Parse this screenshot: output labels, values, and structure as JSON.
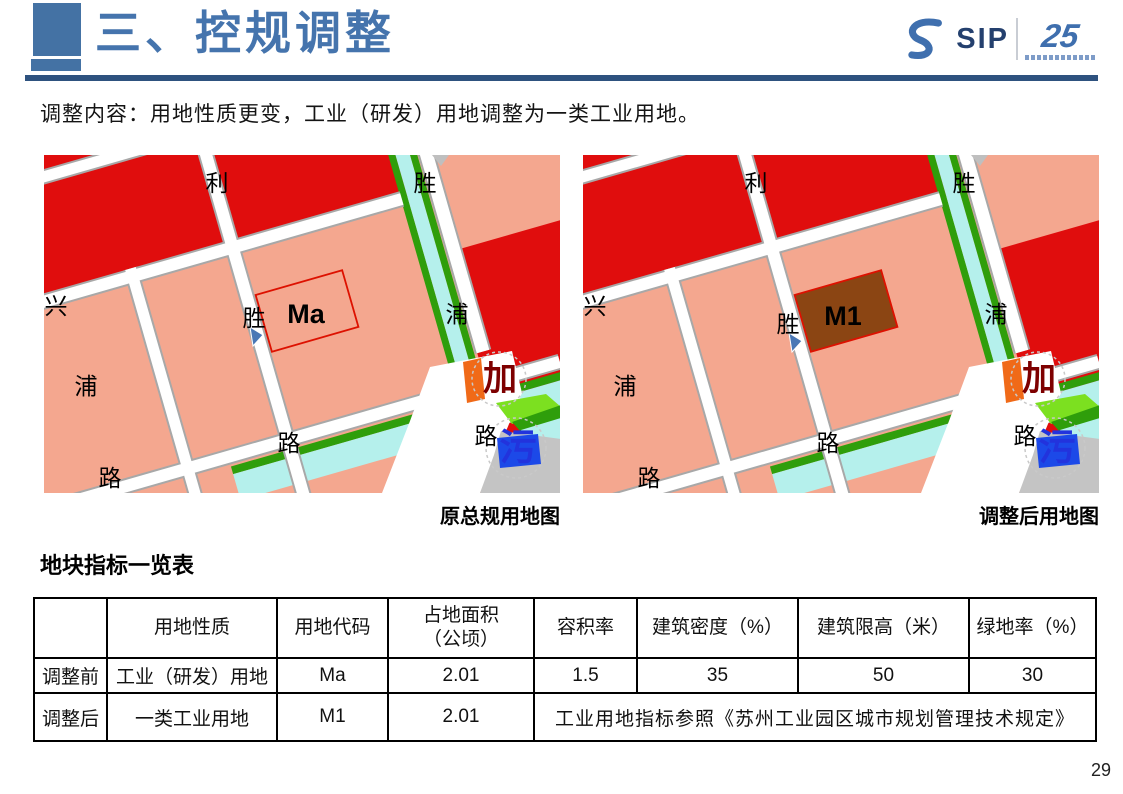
{
  "header": {
    "title": "三、控规调整"
  },
  "logo": {
    "sip": "SIP",
    "anniversary": "25"
  },
  "intro": "调整内容：用地性质更变，工业（研发）用地调整为一类工业用地。",
  "maps": [
    {
      "caption": "原总规用地图",
      "parcel_label": "Ma",
      "parcel_fill": "none",
      "labels": {
        "li": "利",
        "sheng_top": "胜",
        "xing": "兴",
        "pu_right": "浦",
        "sheng_mid": "胜",
        "pu_left": "浦",
        "lu_bl": "路",
        "lu_bc": "路",
        "lu_br": "路",
        "jia": "加",
        "wu": "污"
      }
    },
    {
      "caption": "调整后用地图",
      "parcel_label": "M1",
      "parcel_fill": "#8B4513",
      "labels": {
        "li": "利",
        "sheng_top": "胜",
        "xing": "兴",
        "pu_right": "浦",
        "sheng_mid": "胜",
        "pu_left": "浦",
        "lu_bl": "路",
        "lu_bc": "路",
        "lu_br": "路",
        "jia": "加",
        "wu": "污"
      }
    }
  ],
  "table": {
    "title": "地块指标一览表",
    "headers": [
      "",
      "用地性质",
      "用地代码",
      "占地面积\n（公顷）",
      "容积率",
      "建筑密度（%）",
      "建筑限高（米）",
      "绿地率（%）"
    ],
    "rows": [
      {
        "label": "调整前",
        "cells": [
          "工业（研发）用地",
          "Ma",
          "2.01",
          "1.5",
          "35",
          "50",
          "30"
        ]
      },
      {
        "label": "调整后",
        "cells": [
          "一类工业用地",
          "M1",
          "2.01"
        ],
        "merged": "工业用地指标参照《苏州工业园区城市规划管理技术规定》"
      }
    ]
  },
  "page_number": "29",
  "colors": {
    "title_blue": "#4574AD",
    "accent_bar": "#4472A4",
    "rule_blue": "#2E527F",
    "red_text": "#C00000",
    "parcel_red": "#E00D0D",
    "parcel_salmon": "#F4A78F",
    "canal_cyan": "#B5F0EC",
    "green_dark": "#2F9E0B",
    "green_bright": "#7CE020",
    "m1_brown": "#8B4513",
    "sewage_blue": "#2233DD",
    "station_orange": "#F06A18",
    "map_gray": "#C4C4C4",
    "building_blue": "#1C49E8"
  }
}
